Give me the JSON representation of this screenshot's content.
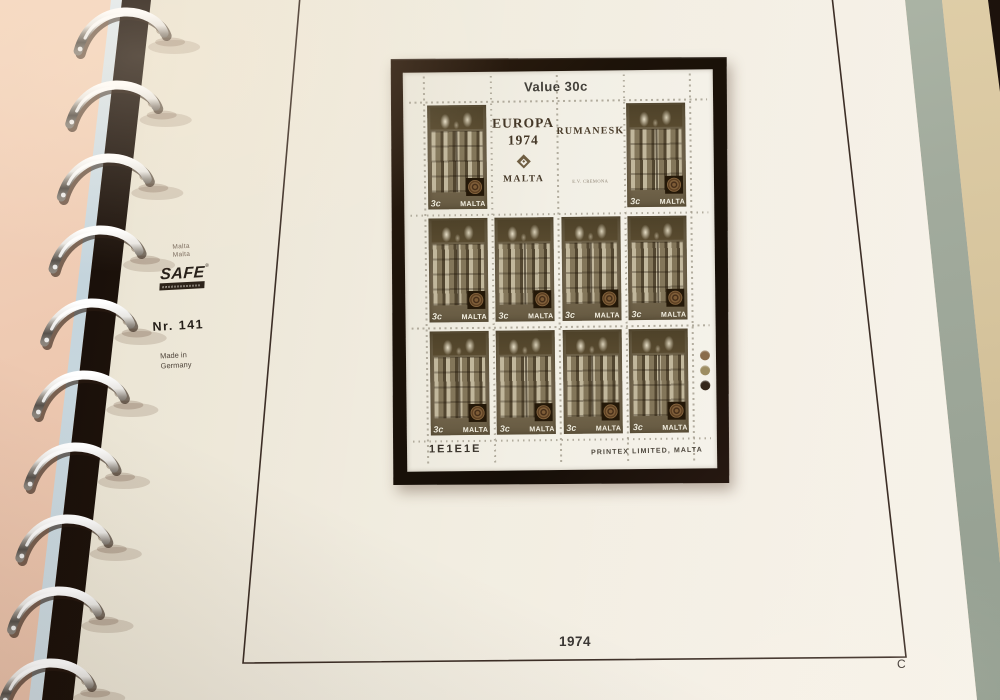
{
  "page": {
    "margin": {
      "country_line1": "Malta",
      "country_line2": "Malta",
      "brand": "SAFE",
      "brand_reg": "®",
      "number": "Nr. 141",
      "made_line1": "Made in",
      "made_line2": "Germany"
    },
    "year": "1974",
    "corner_letter": "C"
  },
  "sheet": {
    "title": "Value 30c",
    "labels": {
      "europa_line1": "EUROPA",
      "europa_line2": "1974",
      "europa_country": "MALTA",
      "romanesk": "RUMANESK",
      "designer": "E.V. CREMONA",
      "emblem_icon": "printer-rosette-diamond"
    },
    "stamp": {
      "value": "3c",
      "country": "MALTA"
    },
    "grid": [
      [
        "stamp",
        "europa",
        "romanesk",
        "stamp"
      ],
      [
        "stamp",
        "stamp",
        "stamp",
        "stamp"
      ],
      [
        "stamp",
        "stamp",
        "stamp",
        "stamp"
      ]
    ],
    "stamp_count": 10,
    "footer": {
      "plate": "1E1E1E",
      "printer": "PRINTEX LIMITED, MALTA"
    },
    "traffic_lights": [
      "#8a6c4c",
      "#9d8d62",
      "#35271a"
    ]
  },
  "colors": {
    "background_pink": "#eac5ae",
    "page_cream": "#f1ece0",
    "frame_brown": "#3c2e26",
    "mount_black": "#1c120a",
    "stamp_olive": "#6e6148",
    "strip_green": "#a4ae9e",
    "strip_tan": "#d8c69f",
    "ring_chrome": "#e8e6e2"
  }
}
